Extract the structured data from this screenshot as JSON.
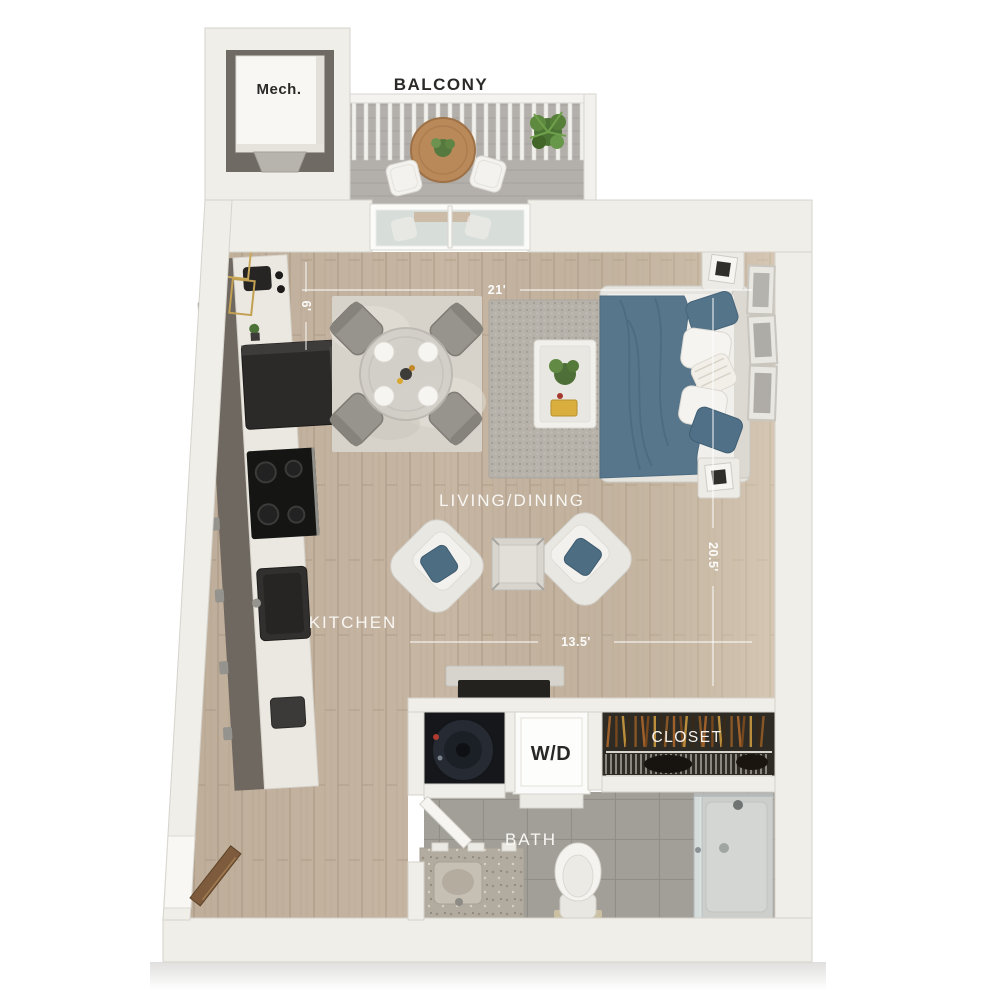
{
  "floorplan": {
    "type": "3d-top-down-studio-apartment-floor-plan",
    "labels": {
      "balcony": "BALCONY",
      "mech": "Mech.",
      "living_dining": "LIVING/DINING",
      "kitchen": "KITCHEN",
      "bath": "BATH",
      "closet": "CLOSET",
      "washer_dryer": "W/D"
    },
    "dimensions": {
      "top_width": "21'",
      "kitchen_width": "6'",
      "bottom_width": "13.5'",
      "side_length": "20.5'"
    },
    "colors": {
      "background": "#ffffff",
      "wall": "#f0eee9",
      "wood_floor": "#c6b6a3",
      "bath_tile": "#a29f99",
      "balcony_floor": "#b3b0ab",
      "accent_blanket_blue": "#57768b",
      "pillow_blue": "#4d6d83",
      "cabinet_dark": "#6f6860",
      "appliance_black": "#2b2a28",
      "door_wood": "#7d5b3c",
      "closet_interior": "#2e2a24",
      "plant_green": "#4c7434",
      "label_light": "#ffffff",
      "label_dark": "#2b2a28"
    }
  }
}
